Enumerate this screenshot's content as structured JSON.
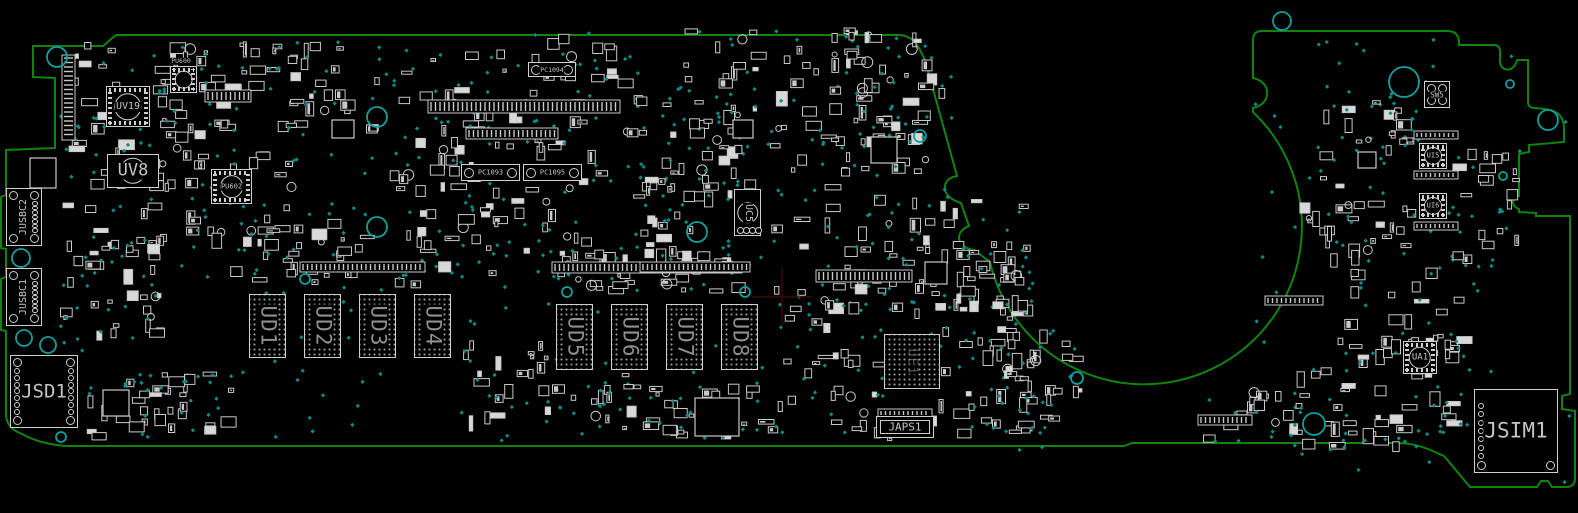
{
  "canvas": {
    "width": 1578,
    "height": 513,
    "background": "#000000"
  },
  "colors": {
    "board_outline": "#0f840f",
    "component_stroke": "#c9c9c9",
    "via_teal": "#0d8c8c",
    "mounting_hole": "#10a0a0",
    "label": "#c4c4c4",
    "bga_label": "#8f8f8f",
    "crosshair": "#4b0a0a"
  },
  "board": {
    "components": [
      {
        "ref": "JUSBC2",
        "type": "edge-conn",
        "x": 6,
        "y": 188,
        "w": 36,
        "h": 58,
        "rot": -90,
        "fs": 10,
        "corners": 4,
        "padcol": "right"
      },
      {
        "ref": "JUSBC1",
        "type": "edge-conn",
        "x": 6,
        "y": 268,
        "w": 36,
        "h": 58,
        "rot": -90,
        "fs": 10,
        "corners": 4,
        "padcol": "right"
      },
      {
        "ref": "JSD1",
        "type": "card-conn",
        "x": 10,
        "y": 355,
        "w": 68,
        "h": 73,
        "rot": 0,
        "fs": 19,
        "corners": 4,
        "padcol": "both"
      },
      {
        "ref": "JSIM1",
        "type": "card-conn",
        "x": 1474,
        "y": 389,
        "w": 84,
        "h": 84,
        "rot": 0,
        "fs": 21,
        "corners": 2,
        "padcol": "left"
      },
      {
        "ref": "UV19",
        "type": "qfn",
        "x": 106,
        "y": 86,
        "w": 44,
        "h": 41,
        "rot": 0,
        "fs": 10
      },
      {
        "ref": "UV8",
        "type": "rect-circle",
        "x": 107,
        "y": 154,
        "w": 52,
        "h": 34,
        "rot": 0,
        "fs": 17
      },
      {
        "ref": "PU600",
        "type": "qfn-above",
        "x": 170,
        "y": 66,
        "w": 27,
        "h": 27,
        "rot": 0,
        "fs": 6.5
      },
      {
        "ref": "PU602",
        "type": "qfn",
        "x": 211,
        "y": 169,
        "w": 41,
        "h": 35,
        "rot": 0,
        "fs": 7
      },
      {
        "ref": "PC1094",
        "type": "pad-conn",
        "x": 528,
        "y": 62,
        "w": 48,
        "h": 15,
        "rot": 0,
        "fs": 6.5
      },
      {
        "ref": "PC1093",
        "type": "pad-conn",
        "x": 461,
        "y": 164,
        "w": 59,
        "h": 17,
        "rot": 0,
        "fs": 7
      },
      {
        "ref": "PC1095",
        "type": "pad-conn",
        "x": 523,
        "y": 164,
        "w": 59,
        "h": 17,
        "rot": 0,
        "fs": 7
      },
      {
        "ref": "UC5",
        "type": "rect-circle",
        "x": 734,
        "y": 189,
        "w": 27,
        "h": 47,
        "rot": 90,
        "fs": 10,
        "padsBottom": true
      },
      {
        "ref": "UE1",
        "type": "bga",
        "x": 884,
        "y": 334,
        "w": 56,
        "h": 55,
        "rot": 90,
        "fs": 13,
        "faint": true
      },
      {
        "ref": "UD1",
        "type": "bga",
        "x": 249,
        "y": 294,
        "w": 37,
        "h": 64,
        "rot": 90,
        "fs": 21
      },
      {
        "ref": "UD2",
        "type": "bga",
        "x": 304,
        "y": 294,
        "w": 37,
        "h": 64,
        "rot": 90,
        "fs": 21
      },
      {
        "ref": "UD3",
        "type": "bga",
        "x": 359,
        "y": 294,
        "w": 37,
        "h": 64,
        "rot": 90,
        "fs": 21
      },
      {
        "ref": "UD4",
        "type": "bga",
        "x": 414,
        "y": 294,
        "w": 37,
        "h": 64,
        "rot": 90,
        "fs": 21
      },
      {
        "ref": "UD5",
        "type": "bga",
        "x": 556,
        "y": 304,
        "w": 37,
        "h": 66,
        "rot": 90,
        "fs": 21
      },
      {
        "ref": "UD6",
        "type": "bga",
        "x": 611,
        "y": 304,
        "w": 37,
        "h": 66,
        "rot": 90,
        "fs": 21
      },
      {
        "ref": "UD7",
        "type": "bga",
        "x": 666,
        "y": 304,
        "w": 37,
        "h": 66,
        "rot": 90,
        "fs": 21
      },
      {
        "ref": "UD8",
        "type": "bga",
        "x": 721,
        "y": 304,
        "w": 37,
        "h": 66,
        "rot": 90,
        "fs": 21
      },
      {
        "ref": "JAPS1",
        "type": "labeled-conn",
        "x": 876,
        "y": 416,
        "w": 58,
        "h": 22,
        "rot": 0,
        "fs": 11
      },
      {
        "ref": "SW5",
        "type": "switch",
        "x": 1424,
        "y": 81,
        "w": 26,
        "h": 27,
        "rot": 0,
        "fs": 7.5,
        "corners": 4
      },
      {
        "ref": "UI5",
        "type": "qfn",
        "x": 1419,
        "y": 143,
        "w": 28,
        "h": 26,
        "rot": 0,
        "fs": 7
      },
      {
        "ref": "UI6",
        "type": "qfn",
        "x": 1419,
        "y": 193,
        "w": 28,
        "h": 26,
        "rot": 0,
        "fs": 7
      },
      {
        "ref": "UA1",
        "type": "qfn",
        "x": 1403,
        "y": 341,
        "w": 34,
        "h": 33,
        "rot": 0,
        "fs": 9
      }
    ],
    "holes": [
      {
        "x": 57,
        "y": 57,
        "r": 10
      },
      {
        "x": 21,
        "y": 258,
        "r": 9
      },
      {
        "x": 24,
        "y": 338,
        "r": 8
      },
      {
        "x": 48,
        "y": 345,
        "r": 8
      },
      {
        "x": 61,
        "y": 437,
        "r": 5
      },
      {
        "x": 377,
        "y": 117,
        "r": 10
      },
      {
        "x": 377,
        "y": 227,
        "r": 10
      },
      {
        "x": 305,
        "y": 279,
        "r": 5
      },
      {
        "x": 697,
        "y": 232,
        "r": 10
      },
      {
        "x": 567,
        "y": 292,
        "r": 5
      },
      {
        "x": 745,
        "y": 292,
        "r": 5
      },
      {
        "x": 920,
        "y": 136,
        "r": 6
      },
      {
        "x": 1282,
        "y": 21,
        "r": 9
      },
      {
        "x": 1404,
        "y": 82,
        "r": 15
      },
      {
        "x": 1548,
        "y": 120,
        "r": 10
      },
      {
        "x": 1314,
        "y": 424,
        "r": 11
      },
      {
        "x": 1077,
        "y": 378,
        "r": 6
      },
      {
        "x": 1510,
        "y": 84,
        "r": 4
      },
      {
        "x": 1503,
        "y": 176,
        "r": 4
      }
    ],
    "crosshair": {
      "x": 782,
      "y": 297
    }
  }
}
